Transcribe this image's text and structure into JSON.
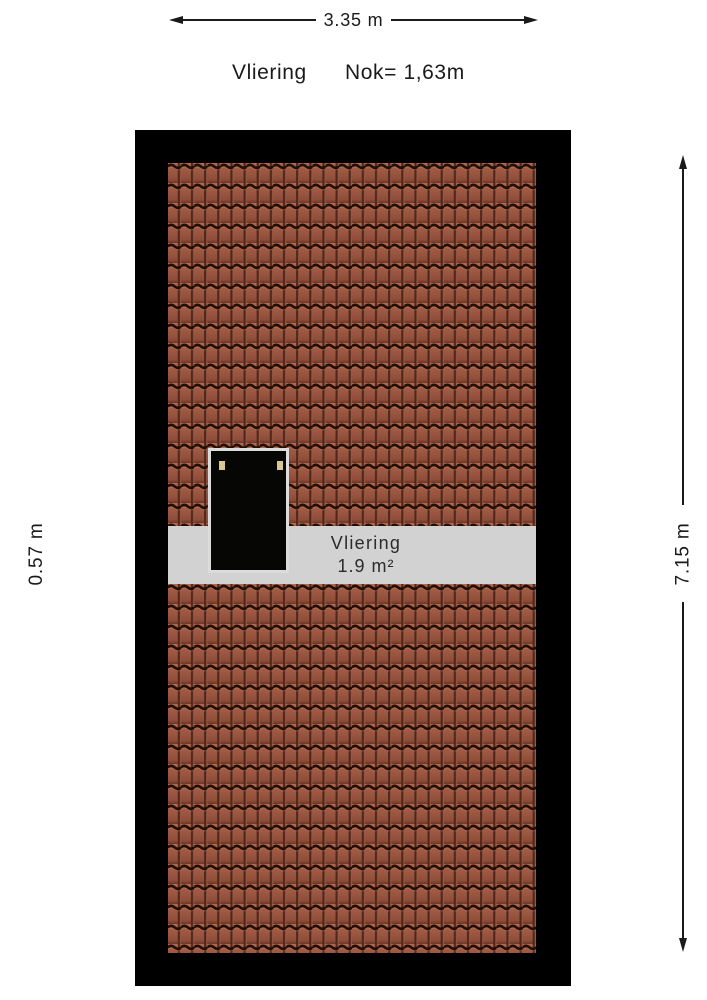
{
  "header": {
    "room_label": "Vliering",
    "ridge_label": "Nok= 1,63m"
  },
  "dimensions": {
    "width_label": "3.35 m",
    "height_label": "7.15 m",
    "band_depth_label": "0.57 m"
  },
  "band": {
    "room_label": "Vliering",
    "area_label": "1.9 m²"
  },
  "colors": {
    "background": "#ffffff",
    "ink": "#1a1a1a",
    "frame_black": "#000000",
    "tile_base": "#9c5843",
    "tile_highlight": "#b26a4f",
    "tile_shadow": "#6e3627",
    "tile_groove": "#200e07",
    "band_gray": "#d2d2d2",
    "band_text": "#2b2b2b",
    "skylight_fill": "#060604",
    "skylight_border": "#dcdcdc",
    "hinge_tan": "#d9c894"
  }
}
